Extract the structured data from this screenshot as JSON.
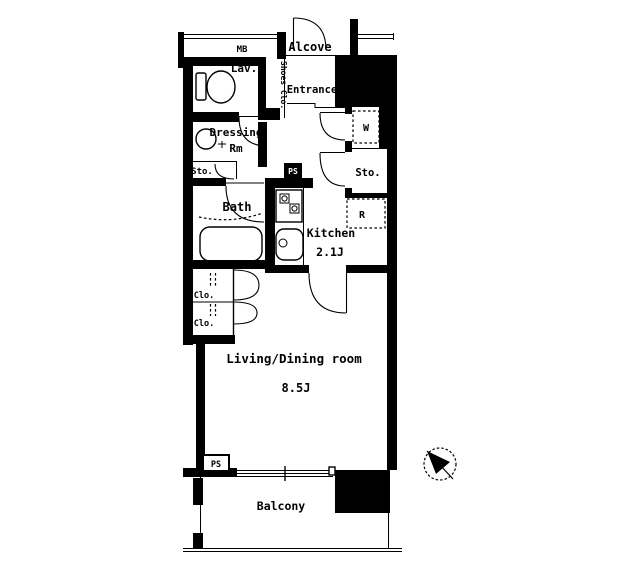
{
  "title": "apartment-floor-plan",
  "colors": {
    "ink": "#000000",
    "paper": "#ffffff"
  },
  "rooms": {
    "meter_box": {
      "label": "MB"
    },
    "alcove": {
      "label": "Alcove"
    },
    "lavatory": {
      "label": "Lav."
    },
    "shoes_closet": {
      "label": "Shoes Clo."
    },
    "entrance": {
      "label": "Entrance"
    },
    "dressing_room": {
      "label_line1": "Dressing",
      "label_line2": "Rm"
    },
    "storage_left": {
      "label": "Sto."
    },
    "pipe_space_top": {
      "label": "PS"
    },
    "washer_space": {
      "label": "W"
    },
    "storage_right": {
      "label": "Sto."
    },
    "bath": {
      "label": "Bath"
    },
    "kitchen": {
      "label": "Kitchen",
      "size": "2.1J"
    },
    "refrigerator_space": {
      "label": "R"
    },
    "closet_upper": {
      "label": "Clo."
    },
    "closet_lower": {
      "label": "Clo."
    },
    "living_dining": {
      "label": "Living/Dining room",
      "size": "8.5J"
    },
    "pipe_space_bottom": {
      "label": "PS"
    },
    "balcony": {
      "label": "Balcony"
    }
  }
}
